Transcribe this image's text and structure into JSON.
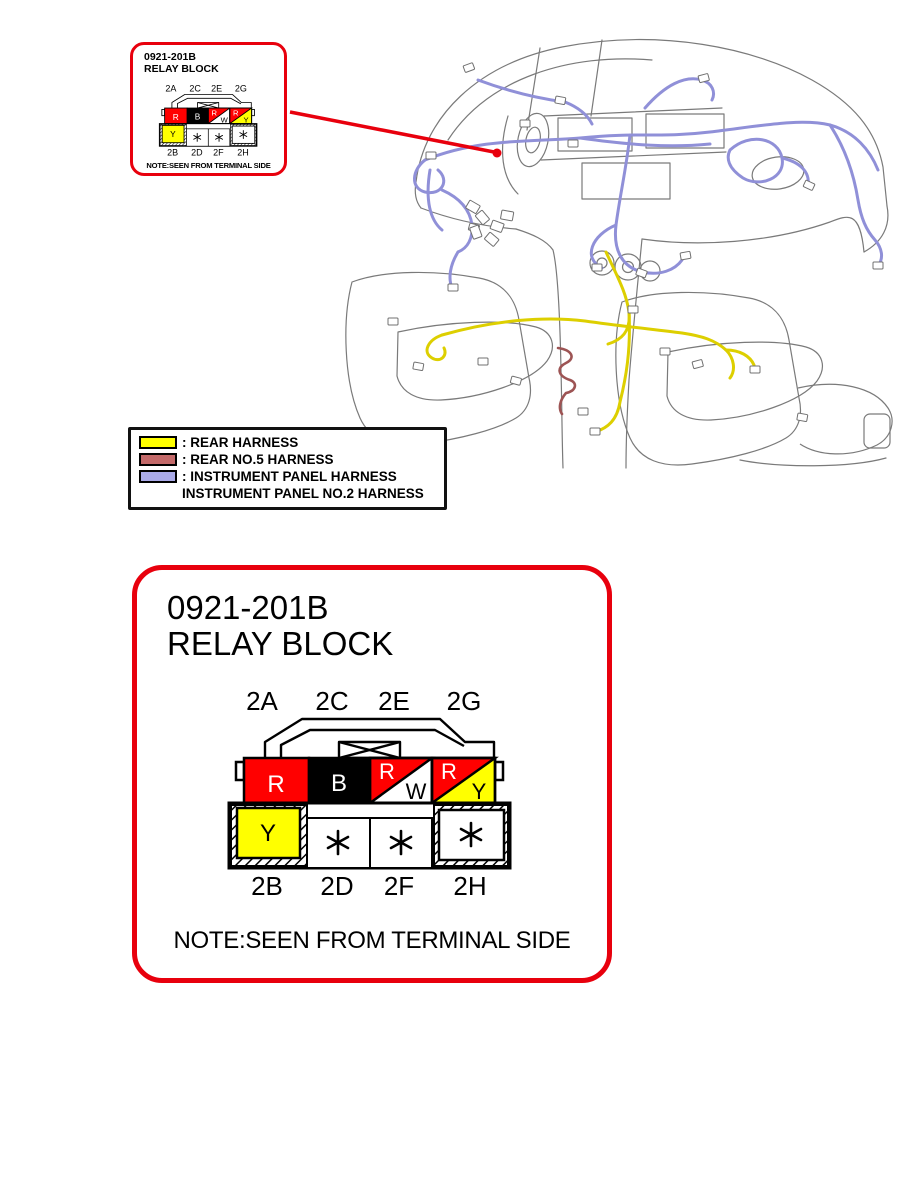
{
  "colors": {
    "callout_red": "#e8000d",
    "cell_red": "#ff0000",
    "cell_yellow": "#ffff00",
    "cell_black": "#000000",
    "harness_yellow": "#ddcf00",
    "harness_blue": "#9090d8",
    "harness_maroon": "#9d5454",
    "legend_yellow": "#ffff00",
    "legend_red": "#c46a6a",
    "legend_blue": "#aaaae8"
  },
  "callout": {
    "part_number": "0921-201B",
    "part_name": "RELAY BLOCK",
    "note": "NOTE:SEEN FROM TERMINAL SIDE"
  },
  "detail": {
    "part_number": "0921-201B",
    "part_name": "RELAY BLOCK",
    "note": "NOTE:SEEN FROM TERMINAL SIDE"
  },
  "connector": {
    "top_pins": [
      {
        "id": "2A",
        "wire_color": "R"
      },
      {
        "id": "2C",
        "wire_color": "B"
      },
      {
        "id": "2E",
        "wire_color": "R/W"
      },
      {
        "id": "2G",
        "wire_color": "R/Y"
      }
    ],
    "bottom_pins": [
      {
        "id": "2B",
        "wire_color": "Y"
      },
      {
        "id": "2D",
        "wire_color": "*"
      },
      {
        "id": "2F",
        "wire_color": "*"
      },
      {
        "id": "2H",
        "wire_color": "*"
      }
    ],
    "letters": {
      "c1": "R",
      "c2": "B",
      "c3a": "R",
      "c3b": "W",
      "c4a": "R",
      "c4b": "Y",
      "c5": "Y"
    }
  },
  "legend": {
    "items": [
      {
        "swatch": "#ffff00",
        "label": ": REAR HARNESS"
      },
      {
        "swatch": "#c46a6a",
        "label": ": REAR NO.5 HARNESS"
      },
      {
        "swatch": "#aaaae8",
        "label": ": INSTRUMENT PANEL HARNESS"
      },
      {
        "swatch": "",
        "label": "INSTRUMENT PANEL NO.2 HARNESS"
      }
    ]
  }
}
